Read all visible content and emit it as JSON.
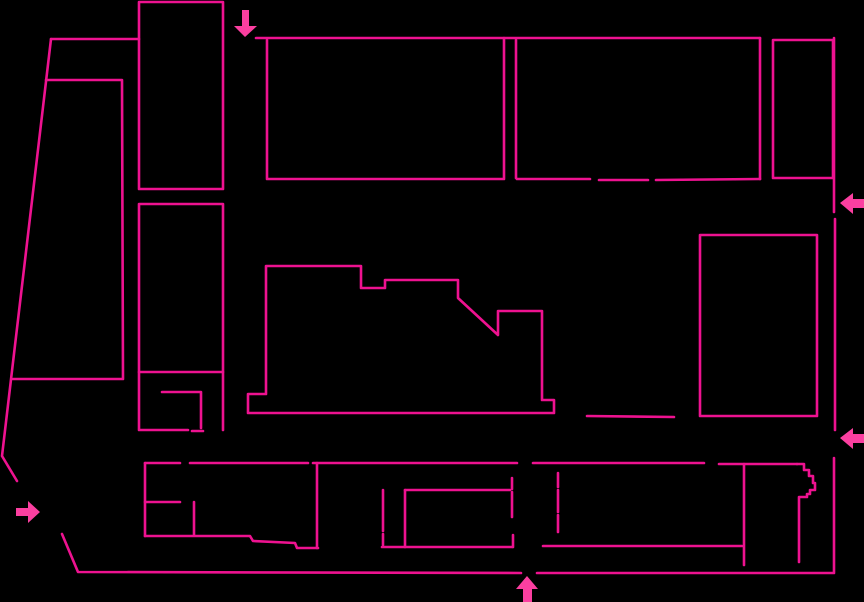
{
  "canvas": {
    "width": 864,
    "height": 602,
    "background_color": "#000000"
  },
  "stroke": {
    "color": "#ee1290",
    "width": 2.6
  },
  "arrow": {
    "color": "#fb3fa0"
  },
  "shapes": [
    {
      "name": "boundary-top-west",
      "points": [
        [
          51,
          39
        ],
        [
          139,
          39
        ]
      ]
    },
    {
      "name": "boundary-west-slant",
      "points": [
        [
          51,
          39
        ],
        [
          2,
          456
        ],
        [
          17,
          481
        ]
      ]
    },
    {
      "name": "boundary-southwest",
      "points": [
        [
          62,
          534
        ],
        [
          78,
          572
        ],
        [
          521,
          573
        ]
      ]
    },
    {
      "name": "boundary-south-east",
      "points": [
        [
          537,
          573
        ],
        [
          834,
          573
        ],
        [
          834,
          458
        ]
      ]
    },
    {
      "name": "boundary-east-mid",
      "points": [
        [
          835,
          219
        ],
        [
          835,
          430
        ]
      ]
    },
    {
      "name": "boundary-east-top",
      "points": [
        [
          834,
          38
        ],
        [
          834,
          212
        ]
      ]
    },
    {
      "name": "boundary-top-main",
      "points": [
        [
          256,
          38
        ],
        [
          760,
          38
        ]
      ]
    },
    {
      "name": "northwest-tall-building",
      "points": [
        [
          139,
          189
        ],
        [
          139,
          2
        ],
        [
          223,
          2
        ],
        [
          223,
          189
        ],
        [
          139,
          189
        ]
      ]
    },
    {
      "name": "west-building",
      "points": [
        [
          139,
          204
        ],
        [
          223,
          204
        ],
        [
          223,
          372
        ],
        [
          139,
          372
        ],
        [
          139,
          204
        ]
      ]
    },
    {
      "name": "west-annex-west-south",
      "points": [
        [
          139,
          372
        ],
        [
          139,
          430
        ],
        [
          188,
          430
        ]
      ]
    },
    {
      "name": "west-annex-south-stub",
      "points": [
        [
          192,
          431
        ],
        [
          203,
          431
        ]
      ]
    },
    {
      "name": "west-annex-east",
      "points": [
        [
          223,
          372
        ],
        [
          223,
          430
        ]
      ]
    },
    {
      "name": "west-annex-hook",
      "points": [
        [
          162,
          392
        ],
        [
          201,
          392
        ],
        [
          201,
          428
        ]
      ]
    },
    {
      "name": "west-trapezoid-block",
      "points": [
        [
          46,
          80
        ],
        [
          122,
          80
        ],
        [
          123,
          379
        ],
        [
          13,
          379
        ]
      ]
    },
    {
      "name": "north-building-a",
      "points": [
        [
          267,
          40
        ],
        [
          267,
          179
        ],
        [
          504,
          179
        ],
        [
          504,
          38
        ]
      ]
    },
    {
      "name": "north-building-b-west",
      "points": [
        [
          516,
          40
        ],
        [
          516,
          178
        ]
      ]
    },
    {
      "name": "north-building-b-south-1",
      "points": [
        [
          517,
          179
        ],
        [
          590,
          179
        ]
      ]
    },
    {
      "name": "north-building-b-south-2",
      "points": [
        [
          599,
          180
        ],
        [
          648,
          180
        ]
      ]
    },
    {
      "name": "north-building-b-south-3",
      "points": [
        [
          656,
          180
        ],
        [
          760,
          179
        ]
      ]
    },
    {
      "name": "north-building-b-east",
      "points": [
        [
          760,
          38
        ],
        [
          760,
          179
        ]
      ]
    },
    {
      "name": "north-building-c",
      "points": [
        [
          773,
          40
        ],
        [
          833,
          40
        ],
        [
          833,
          178
        ],
        [
          773,
          178
        ],
        [
          773,
          40
        ]
      ]
    },
    {
      "name": "central-building",
      "points": [
        [
          248,
          394
        ],
        [
          266,
          394
        ],
        [
          266,
          266
        ],
        [
          361,
          266
        ],
        [
          361,
          288
        ],
        [
          385,
          288
        ],
        [
          385,
          280
        ],
        [
          458,
          280
        ],
        [
          458,
          298
        ],
        [
          498,
          335
        ],
        [
          498,
          311
        ],
        [
          542,
          311
        ],
        [
          542,
          400
        ],
        [
          554,
          400
        ],
        [
          554,
          413
        ],
        [
          248,
          413
        ],
        [
          248,
          394
        ]
      ]
    },
    {
      "name": "central-walkway-line",
      "points": [
        [
          587,
          416
        ],
        [
          674,
          417
        ]
      ]
    },
    {
      "name": "east-building",
      "points": [
        [
          700,
          235
        ],
        [
          817,
          235
        ],
        [
          817,
          416
        ],
        [
          700,
          416
        ],
        [
          700,
          235
        ]
      ]
    },
    {
      "name": "south-band-top-1",
      "points": [
        [
          145,
          463
        ],
        [
          180,
          463
        ]
      ]
    },
    {
      "name": "south-band-top-2",
      "points": [
        [
          190,
          463
        ],
        [
          308,
          463
        ]
      ]
    },
    {
      "name": "south-band-top-3",
      "points": [
        [
          313,
          463
        ],
        [
          517,
          463
        ]
      ]
    },
    {
      "name": "south-band-top-4",
      "points": [
        [
          533,
          463
        ],
        [
          704,
          463
        ]
      ]
    },
    {
      "name": "south-band-top-5",
      "points": [
        [
          719,
          464
        ],
        [
          797,
          464
        ]
      ]
    },
    {
      "name": "south-band-west",
      "points": [
        [
          145,
          463
        ],
        [
          145,
          536
        ]
      ]
    },
    {
      "name": "south-band-room-h",
      "points": [
        [
          145,
          502
        ],
        [
          180,
          502
        ]
      ]
    },
    {
      "name": "south-band-room-v",
      "points": [
        [
          194,
          502
        ],
        [
          194,
          535
        ]
      ]
    },
    {
      "name": "south-band-bottom-west",
      "points": [
        [
          145,
          536
        ],
        [
          250,
          536
        ],
        [
          253,
          541
        ],
        [
          295,
          543
        ],
        [
          297,
          548
        ],
        [
          318,
          548
        ]
      ]
    },
    {
      "name": "south-band-divider-1",
      "points": [
        [
          317,
          463
        ],
        [
          317,
          548
        ]
      ]
    },
    {
      "name": "south-band-bottom-mid",
      "points": [
        [
          382,
          547
        ],
        [
          512,
          547
        ]
      ]
    },
    {
      "name": "south-band-bottom-east",
      "points": [
        [
          543,
          546
        ],
        [
          742,
          546
        ]
      ]
    },
    {
      "name": "south-band-inner-v1a",
      "points": [
        [
          383,
          490
        ],
        [
          383,
          531
        ]
      ]
    },
    {
      "name": "south-band-inner-v1b",
      "points": [
        [
          383,
          534
        ],
        [
          383,
          545
        ]
      ]
    },
    {
      "name": "south-band-inner-v2",
      "points": [
        [
          405,
          490
        ],
        [
          405,
          547
        ]
      ]
    },
    {
      "name": "south-band-inner-h",
      "points": [
        [
          405,
          490
        ],
        [
          510,
          490
        ]
      ]
    },
    {
      "name": "south-band-dash-a1",
      "points": [
        [
          512,
          478
        ],
        [
          512,
          489
        ]
      ]
    },
    {
      "name": "south-band-dash-a2",
      "points": [
        [
          512,
          492
        ],
        [
          512,
          517
        ]
      ]
    },
    {
      "name": "south-band-dash-a3",
      "points": [
        [
          513,
          535
        ],
        [
          513,
          547
        ]
      ]
    },
    {
      "name": "south-band-dash-b1",
      "points": [
        [
          558,
          473
        ],
        [
          558,
          487
        ]
      ]
    },
    {
      "name": "south-band-dash-b2",
      "points": [
        [
          558,
          490
        ],
        [
          558,
          512
        ]
      ]
    },
    {
      "name": "south-band-dash-b3",
      "points": [
        [
          558,
          515
        ],
        [
          558,
          532
        ]
      ]
    },
    {
      "name": "south-band-divider-2",
      "points": [
        [
          744,
          464
        ],
        [
          744,
          565
        ]
      ]
    },
    {
      "name": "south-band-stair-edge",
      "points": [
        [
          797,
          464
        ],
        [
          804,
          464
        ],
        [
          804,
          470
        ],
        [
          809,
          470
        ],
        [
          809,
          476
        ],
        [
          813,
          476
        ],
        [
          813,
          483
        ],
        [
          815,
          483
        ],
        [
          815,
          490
        ],
        [
          810,
          490
        ],
        [
          810,
          494
        ],
        [
          807,
          494
        ],
        [
          807,
          497
        ],
        [
          799,
          497
        ],
        [
          799,
          562
        ]
      ]
    }
  ],
  "arrows": [
    {
      "name": "entrance-arrow-north",
      "direction": "down",
      "points": [
        [
          242,
          10
        ],
        [
          249,
          10
        ],
        [
          249,
          26
        ],
        [
          257,
          26
        ],
        [
          245,
          37
        ],
        [
          234,
          26
        ],
        [
          242,
          26
        ]
      ]
    },
    {
      "name": "entrance-arrow-east-upper",
      "direction": "left",
      "points": [
        [
          864,
          199
        ],
        [
          853,
          199
        ],
        [
          853,
          193
        ],
        [
          840,
          203
        ],
        [
          853,
          214
        ],
        [
          853,
          208
        ],
        [
          864,
          208
        ]
      ]
    },
    {
      "name": "entrance-arrow-east-lower",
      "direction": "left",
      "points": [
        [
          864,
          434
        ],
        [
          853,
          434
        ],
        [
          853,
          428
        ],
        [
          840,
          438
        ],
        [
          853,
          449
        ],
        [
          853,
          443
        ],
        [
          864,
          443
        ]
      ]
    },
    {
      "name": "entrance-arrow-west",
      "direction": "right",
      "points": [
        [
          16,
          508
        ],
        [
          28,
          508
        ],
        [
          28,
          501
        ],
        [
          40,
          512
        ],
        [
          28,
          523
        ],
        [
          28,
          516
        ],
        [
          16,
          516
        ]
      ]
    },
    {
      "name": "entrance-arrow-south",
      "direction": "up",
      "points": [
        [
          527,
          576
        ],
        [
          538,
          589
        ],
        [
          532,
          589
        ],
        [
          532,
          602
        ],
        [
          523,
          602
        ],
        [
          523,
          589
        ],
        [
          516,
          589
        ]
      ]
    }
  ]
}
